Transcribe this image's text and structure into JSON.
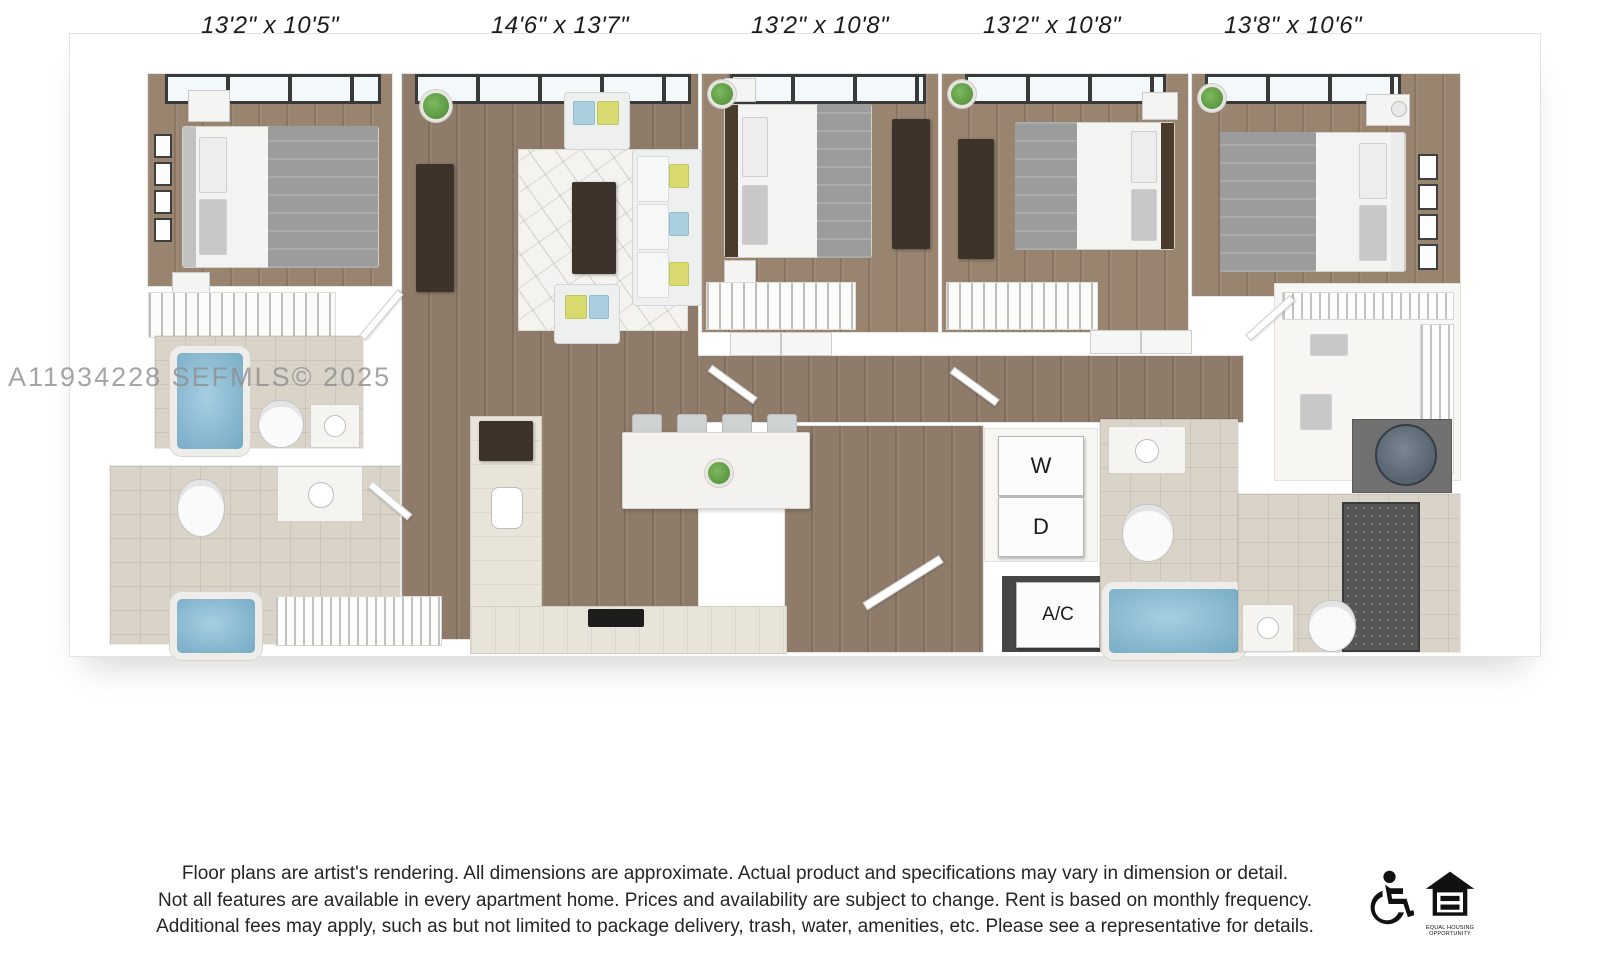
{
  "floorplan": {
    "watermark": "A11934228  SEFMLS© 2025",
    "rooms": [
      {
        "label": "13'2\" x 10'5\""
      },
      {
        "label": "14'6\" x 13'7\""
      },
      {
        "label": "13'2\" x 10'8\""
      },
      {
        "label": "13'2\" x 10'8\""
      },
      {
        "label": "13'8\" x 10'6\""
      }
    ],
    "appliances": {
      "washer": "W",
      "dryer": "D",
      "ac": "A/C"
    },
    "palette": {
      "wood_floor": "#8e7b69",
      "bedroom_wood": "#98846f",
      "bath_tile": "#d9d3c8",
      "tub_blue": "#74a9c4",
      "accent_yellow": "#d8da70",
      "accent_blue": "#aacfdf",
      "dark_furniture": "#3d332a"
    }
  },
  "disclaimer": {
    "line1": "Floor plans are artist's rendering. All dimensions are approximate. Actual product and specifications may vary in dimension or detail.",
    "line2": "Not all features are available in every apartment home. Prices and availability are subject to change. Rent is based on monthly frequency.",
    "line3": "Additional fees may apply, such as but not limited to package delivery, trash, water, amenities, etc. Please see a representative for details."
  },
  "footer": {
    "accessibility_icon": "wheelchair-icon",
    "equal_housing_icon": "equal-housing-icon",
    "caption1": "EQUAL HOUSING",
    "caption2": "OPPORTUNITY"
  }
}
